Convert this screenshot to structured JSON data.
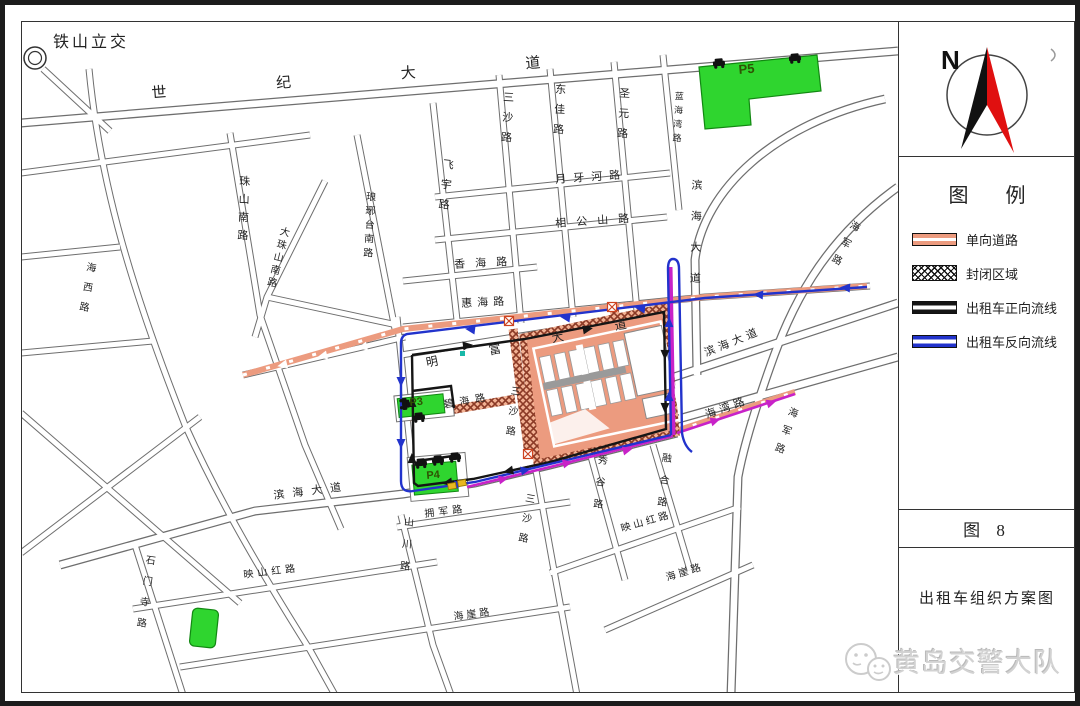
{
  "map": {
    "road_labels": [
      {
        "text": "铁山立交",
        "x": 48,
        "y": 30,
        "s": 16,
        "ls": 3,
        "rot": 0,
        "v": 0
      },
      {
        "text": "世纪大道",
        "x": 146,
        "y": 82,
        "s": 15,
        "ls": 110,
        "rot": -4.5,
        "v": 0
      },
      {
        "text": "三沙路",
        "x": 497,
        "y": 86,
        "s": 11,
        "ls": 9,
        "rot": 3,
        "v": 1
      },
      {
        "text": "东佳路",
        "x": 549,
        "y": 78,
        "s": 11,
        "ls": 9,
        "rot": 3,
        "v": 1
      },
      {
        "text": "圣元路",
        "x": 613,
        "y": 82,
        "s": 11,
        "ls": 9,
        "rot": 3,
        "v": 1
      },
      {
        "text": "蓝海湾路",
        "x": 669,
        "y": 86,
        "s": 9,
        "ls": 5,
        "rot": 3,
        "v": 1
      },
      {
        "text": "飞宇路",
        "x": 437,
        "y": 153,
        "s": 11,
        "ls": 9,
        "rot": 6,
        "v": 1
      },
      {
        "text": "月牙河路",
        "x": 550,
        "y": 170,
        "s": 11,
        "ls": 7,
        "rot": -4,
        "v": 0
      },
      {
        "text": "相公山路",
        "x": 550,
        "y": 214,
        "s": 11,
        "ls": 10,
        "rot": -4,
        "v": 0
      },
      {
        "text": "香海路",
        "x": 449,
        "y": 255,
        "s": 11,
        "ls": 10,
        "rot": -3,
        "v": 0
      },
      {
        "text": "惠海路",
        "x": 456,
        "y": 294,
        "s": 11,
        "ls": 5,
        "rot": -3,
        "v": 0
      },
      {
        "text": "珠山南路",
        "x": 233,
        "y": 170,
        "s": 11,
        "ls": 7,
        "rot": 2,
        "v": 1
      },
      {
        "text": "大珠山南路",
        "x": 274,
        "y": 220,
        "s": 10,
        "ls": 3,
        "rot": 14,
        "v": 1
      },
      {
        "text": "琅琊台南路",
        "x": 359,
        "y": 186,
        "s": 10,
        "ls": 4,
        "rot": 3,
        "v": 1
      },
      {
        "text": "海西路",
        "x": 80,
        "y": 256,
        "s": 10,
        "ls": 10,
        "rot": 10,
        "v": 1
      },
      {
        "text": "滨海大道",
        "x": 685,
        "y": 174,
        "s": 11,
        "ls": 20,
        "rot": 1,
        "v": 1
      },
      {
        "text": "海军路",
        "x": 846,
        "y": 213,
        "s": 10,
        "ls": 9,
        "rot": 28,
        "v": 1
      },
      {
        "text": "海军路",
        "x": 783,
        "y": 400,
        "s": 10,
        "ls": 9,
        "rot": 20,
        "v": 1
      },
      {
        "text": "滨海大道",
        "x": 698,
        "y": 344,
        "s": 11,
        "ls": 4,
        "rot": -22,
        "v": 0
      },
      {
        "text": "海湾路",
        "x": 699,
        "y": 406,
        "s": 11,
        "ls": 4,
        "rot": -20,
        "v": 0
      },
      {
        "text": "明富大道",
        "x": 420,
        "y": 352,
        "s": 12,
        "ls": 52,
        "rot": -11,
        "v": 0
      },
      {
        "text": "碧海路",
        "x": 438,
        "y": 396,
        "s": 10,
        "ls": 6,
        "rot": -10,
        "v": 0
      },
      {
        "text": "三沙路",
        "x": 504,
        "y": 380,
        "s": 10,
        "ls": 10,
        "rot": 7,
        "v": 1
      },
      {
        "text": "三沙路",
        "x": 519,
        "y": 487,
        "s": 10,
        "ls": 10,
        "rot": 10,
        "v": 1
      },
      {
        "text": "拥军路",
        "x": 419,
        "y": 505,
        "s": 10,
        "ls": 4,
        "rot": -7,
        "v": 0
      },
      {
        "text": "山川路",
        "x": 397,
        "y": 511,
        "s": 10,
        "ls": 12,
        "rot": 5,
        "v": 1
      },
      {
        "text": "秀谷路",
        "x": 591,
        "y": 449,
        "s": 10,
        "ls": 12,
        "rot": 6,
        "v": 1
      },
      {
        "text": "融合路",
        "x": 655,
        "y": 447,
        "s": 10,
        "ls": 12,
        "rot": 6,
        "v": 1
      },
      {
        "text": "映山红路",
        "x": 615,
        "y": 520,
        "s": 10,
        "ls": 3,
        "rot": -16,
        "v": 0
      },
      {
        "text": "映山红路",
        "x": 238,
        "y": 566,
        "s": 10,
        "ls": 4,
        "rot": -7,
        "v": 0
      },
      {
        "text": "滨海大道",
        "x": 268,
        "y": 486,
        "s": 11,
        "ls": 8,
        "rot": -7,
        "v": 0
      },
      {
        "text": "石门寺路",
        "x": 139,
        "y": 549,
        "s": 10,
        "ls": 11,
        "rot": 8,
        "v": 1
      },
      {
        "text": "海崖路",
        "x": 660,
        "y": 569,
        "s": 10,
        "ls": 3,
        "rot": -17,
        "v": 0
      },
      {
        "text": "海崖路",
        "x": 448,
        "y": 608,
        "s": 10,
        "ls": 3,
        "rot": -8,
        "v": 0
      }
    ],
    "parking": {
      "p3": "P3",
      "p4": "P4",
      "p5": "P5"
    }
  },
  "compass": {
    "north_label": "N"
  },
  "legend": {
    "title": "图  例",
    "items": [
      {
        "label": "单向道路",
        "type": "oneway"
      },
      {
        "label": "封闭区域",
        "type": "closed"
      },
      {
        "label": "出租车正向流线",
        "type": "forward"
      },
      {
        "label": "出租车反向流线",
        "type": "reverse"
      }
    ]
  },
  "figure": {
    "number": "图 8",
    "title": "出租车组织方案图"
  },
  "watermark": {
    "text": "黄岛交警大队"
  },
  "colors": {
    "oneway_road": "#EC9B7F",
    "closed_hatch": "#8B3A26",
    "forward_flow": "#151515",
    "reverse_flow": "#2233CC",
    "merge_flow": "#C822C8",
    "parking_green": "#2FD52F",
    "compass_red": "#E01010"
  }
}
